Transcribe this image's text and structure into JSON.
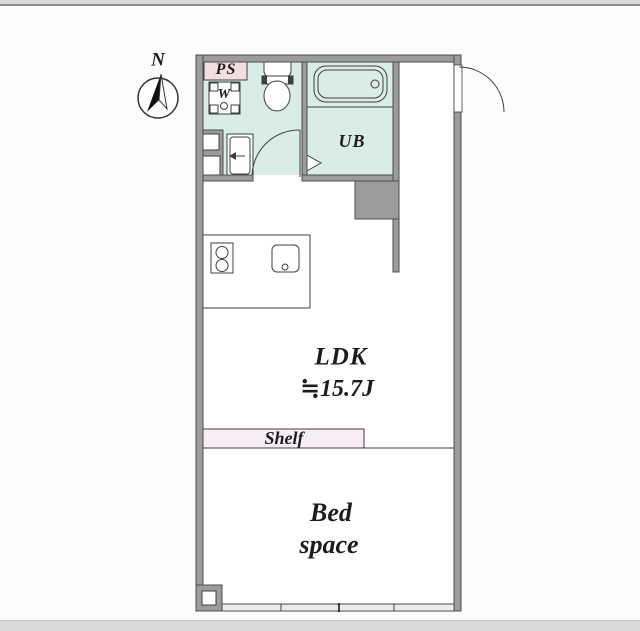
{
  "compass": {
    "north_label": "N"
  },
  "labels": {
    "pipe_space": "PS",
    "washer": "W",
    "unit_bath": "UB",
    "ldk": "LDK",
    "ldk_size": "≒15.7J",
    "shelf": "Shelf",
    "bed_line1": "Bed",
    "bed_line2": "space"
  },
  "colors": {
    "wall": "#9c9c9c",
    "wall-edge": "#4d4d4d",
    "wet-area": "#d9ece8",
    "ps-pink": "#f2dede",
    "shelf-pink": "#f8ecf7",
    "line": "#3f3f3f",
    "chrome-bar": "#d9d9d9",
    "text": "#1c1c1c"
  }
}
